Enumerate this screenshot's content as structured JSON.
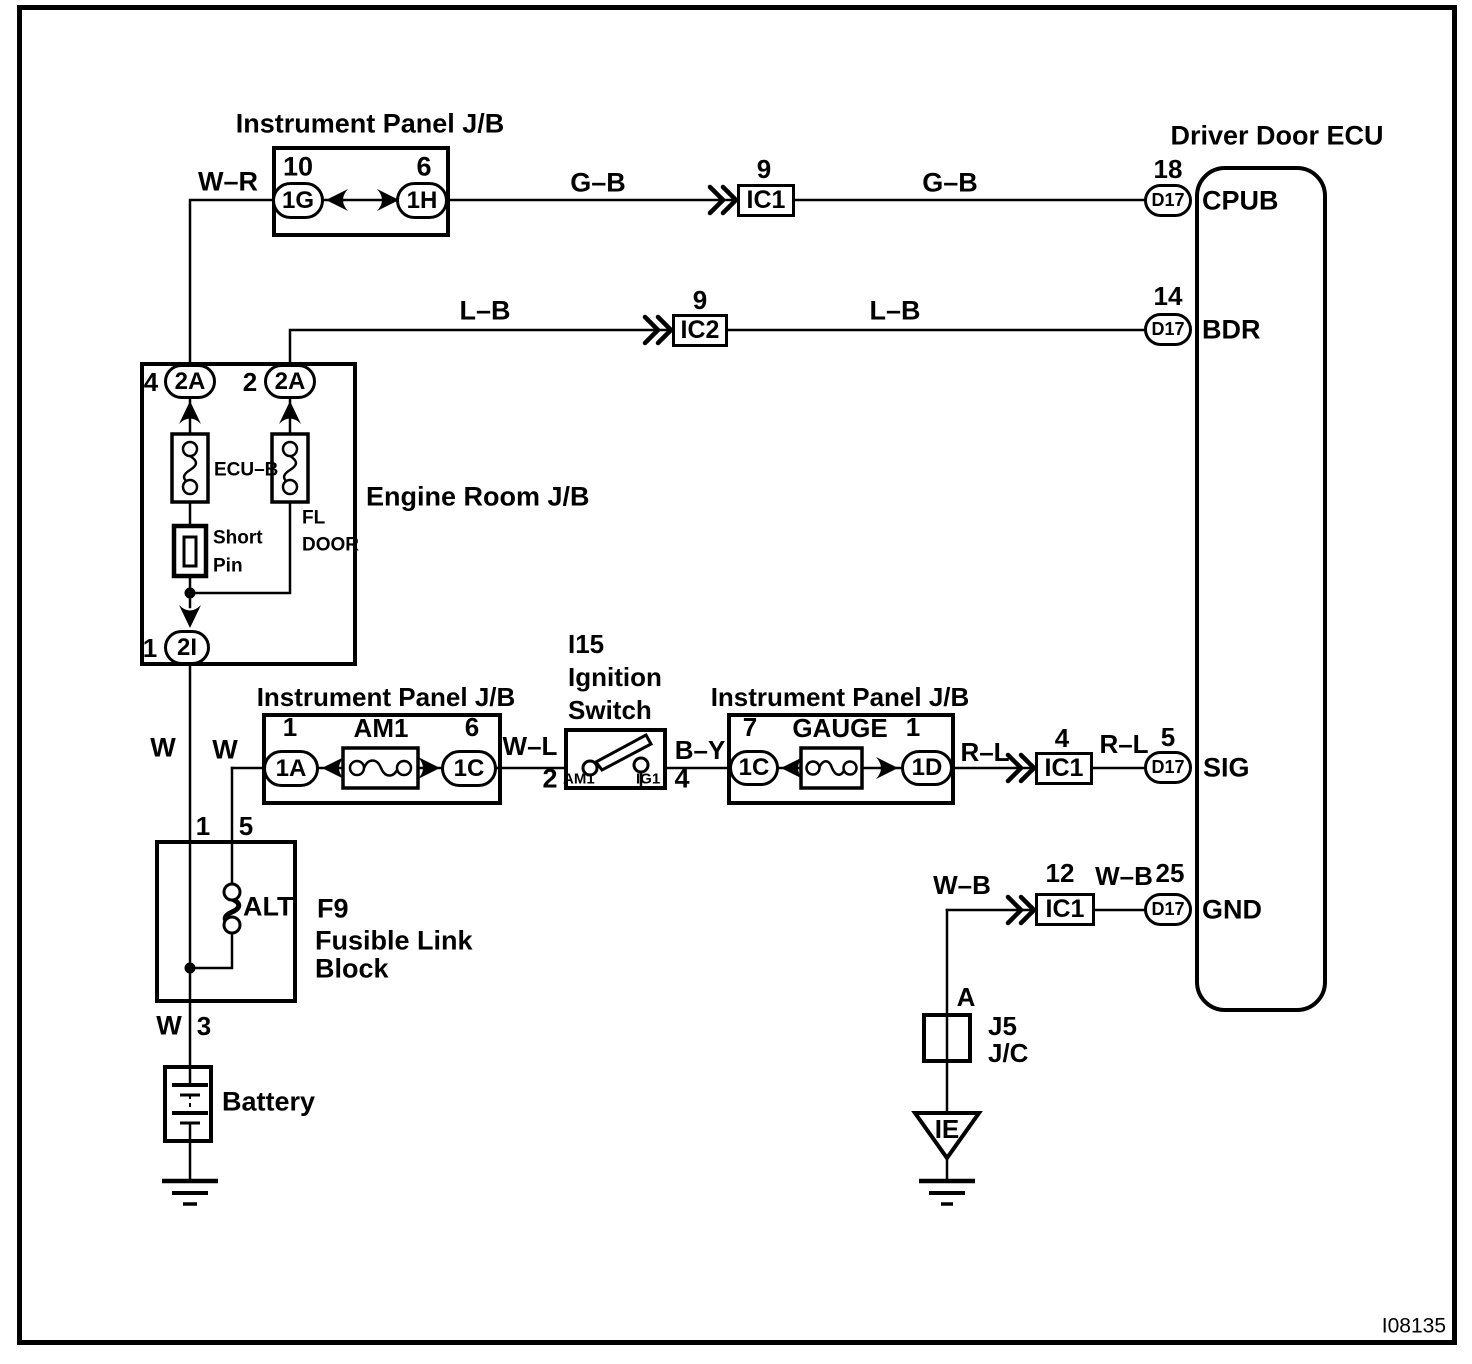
{
  "figure_id": "I08135",
  "ecu": {
    "title": "Driver Door ECU",
    "cpub": {
      "num": "18",
      "conn": "D17",
      "label": "CPUB"
    },
    "bdr": {
      "num": "14",
      "conn": "D17",
      "label": "BDR"
    },
    "sig": {
      "num": "5",
      "conn": "D17",
      "label": "SIG"
    },
    "gnd": {
      "num": "25",
      "conn": "D17",
      "label": "GND"
    }
  },
  "jb_top": {
    "title": "Instrument Panel J/B",
    "left_num": "10",
    "left_conn": "1G",
    "right_num": "6",
    "right_conn": "1H"
  },
  "engine_jb": {
    "title": "Engine Room J/B",
    "left_num": "4",
    "left_conn": "2A",
    "right_num": "2",
    "right_conn": "2A",
    "fuse_left": "ECU–B",
    "fuse_right_line1": "FL",
    "fuse_right_line2": "DOOR",
    "short_pin_line1": "Short",
    "short_pin_line2": "Pin",
    "out_num": "1",
    "out_conn": "2I"
  },
  "jb_am1": {
    "title": "Instrument Panel J/B",
    "left_num": "1",
    "left_conn": "1A",
    "fuse": "AM1",
    "right_num": "6",
    "right_conn": "1C"
  },
  "ignition_switch": {
    "code": "I15",
    "name_line1": "Ignition",
    "name_line2": "Switch",
    "pin_in": "2",
    "pin_out": "4",
    "terminal_left": "AM1",
    "terminal_right": "IG1"
  },
  "jb_gauge": {
    "title": "Instrument Panel J/B",
    "left_num": "7",
    "left_conn": "1C",
    "fuse": "GAUGE",
    "right_num": "1",
    "right_conn": "1D"
  },
  "fusible_block": {
    "name_line1": "F9",
    "name_line2": "Fusible Link",
    "name_line3": "Block",
    "fuse": "ALT",
    "pin_in_left": "1",
    "pin_in_right": "5",
    "pin_out": "3"
  },
  "battery": {
    "label": "Battery"
  },
  "ground_junction": {
    "pin": "A",
    "name_line1": "J5",
    "name_line2": "J/C",
    "ground_code": "IE"
  },
  "connectors": {
    "ic1_top": {
      "num": "9",
      "label": "IC1"
    },
    "ic2": {
      "num": "9",
      "label": "IC2"
    },
    "ic1_sig": {
      "num": "4",
      "label": "IC1"
    },
    "ic1_gnd": {
      "num": "12",
      "label": "IC1"
    }
  },
  "wires": {
    "w_r": "W–R",
    "g_b_left": "G–B",
    "g_b_right": "G–B",
    "l_b_left": "L–B",
    "l_b_right": "L–B",
    "w_main": "W",
    "w_branch": "W",
    "w_battery": "W",
    "w_l": "W–L",
    "b_y": "B–Y",
    "r_l_left": "R–L",
    "r_l_right": "R–L",
    "w_b_left": "W–B",
    "w_b_right": "W–B"
  }
}
